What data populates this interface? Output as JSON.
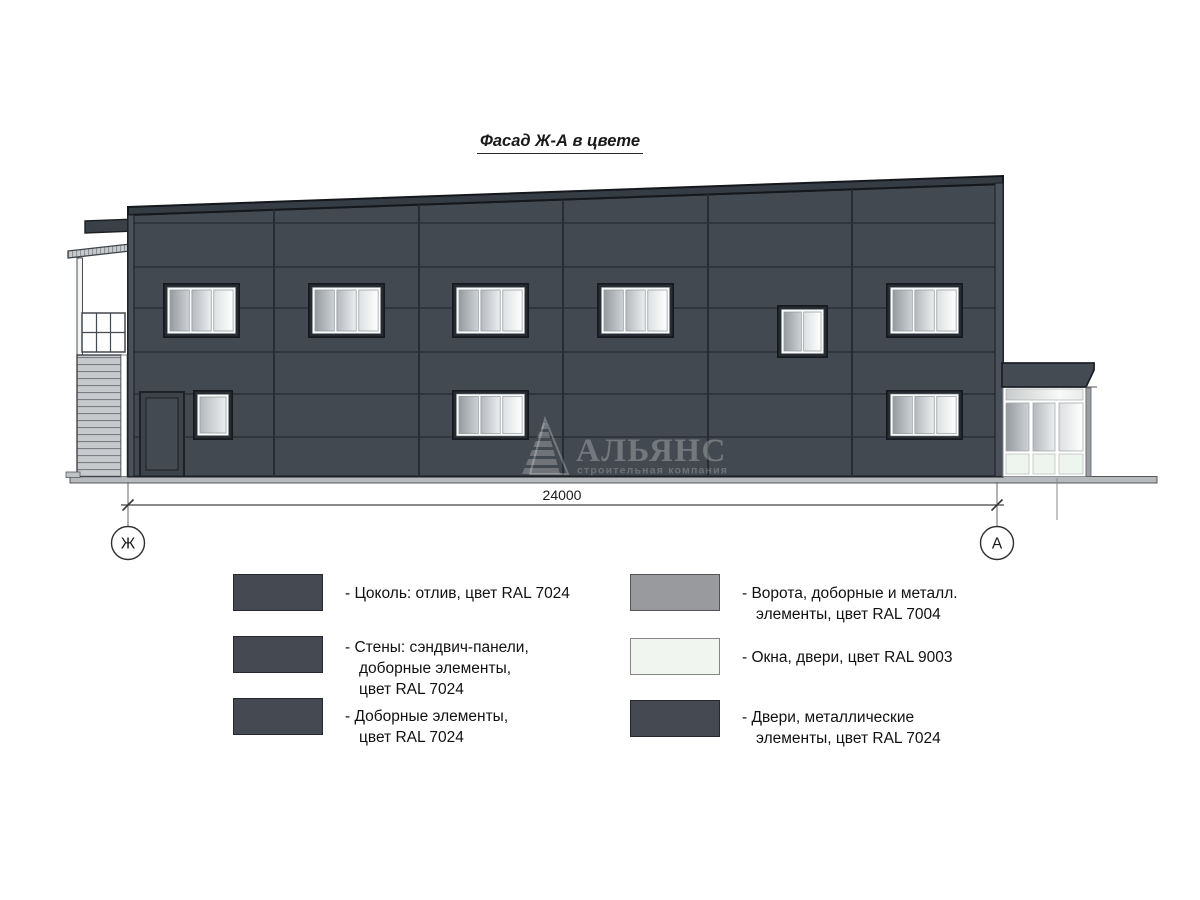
{
  "title": "Фасад Ж-А в цвете",
  "dimension": {
    "value": "24000"
  },
  "axes": {
    "left": "Ж",
    "right": "А"
  },
  "watermark": {
    "name": "АЛЬЯНС",
    "tagline": "строительная компания"
  },
  "colors": {
    "ral_7024_graphite": "#454a52",
    "ral_7004_signal_gray": "#999a9e",
    "ral_9003_signal_white": "#f0f5ef"
  },
  "legend": {
    "left": [
      {
        "swatch_color": "#454a52",
        "label": "- Цоколь: отлив, цвет RAL 7024"
      },
      {
        "swatch_color": "#454a52",
        "label": "- Стены: сэндвич-панели,\nдоборные элементы,\nцвет RAL 7024"
      },
      {
        "swatch_color": "#454a52",
        "label": "- Доборные элементы,\nцвет RAL 7024"
      }
    ],
    "right": [
      {
        "swatch_color": "#999a9e",
        "label": "- Ворота, доборные и металл.\nэлементы, цвет RAL 7004"
      },
      {
        "swatch_color": "#f0f5ef",
        "label": "- Окна, двери, цвет RAL 9003"
      },
      {
        "swatch_color": "#454a52",
        "label": "- Двери, металлические\nэлементы, цвет RAL 7024"
      }
    ]
  }
}
